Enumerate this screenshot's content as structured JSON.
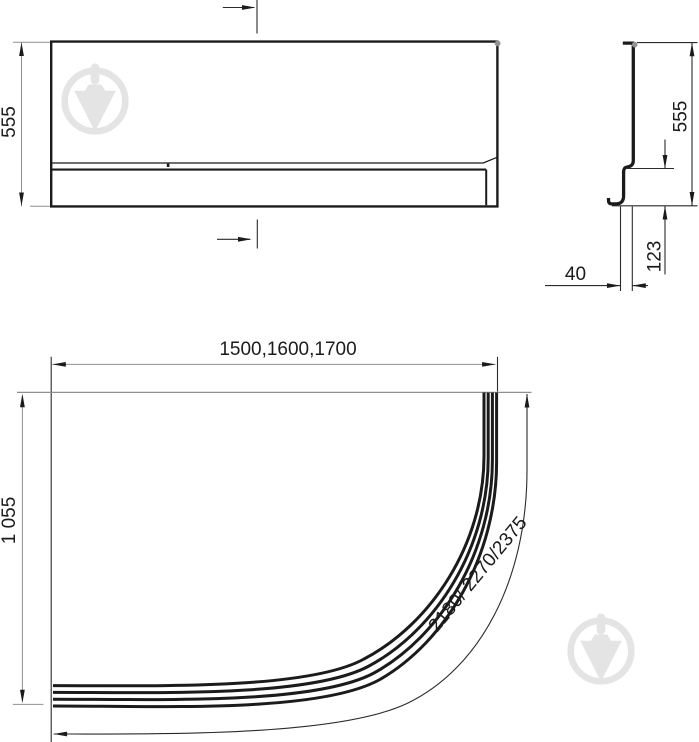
{
  "colors": {
    "line": "#1b1b1b",
    "thin": "#2a2a2a",
    "dim": "#8f8f8f",
    "dot": "#919191",
    "watermark": "#e4e4e4"
  },
  "front_view": {
    "height_label": "555"
  },
  "side_view": {
    "height_label": "555",
    "plinth_label": "123",
    "depth_label": "40"
  },
  "plan_view": {
    "length_label": "1500,1600,1700",
    "width_label": "1 055",
    "arc_label": "2180/ 2270/2375"
  },
  "watermark": {
    "icon": "trowel-in-circle-icon"
  }
}
